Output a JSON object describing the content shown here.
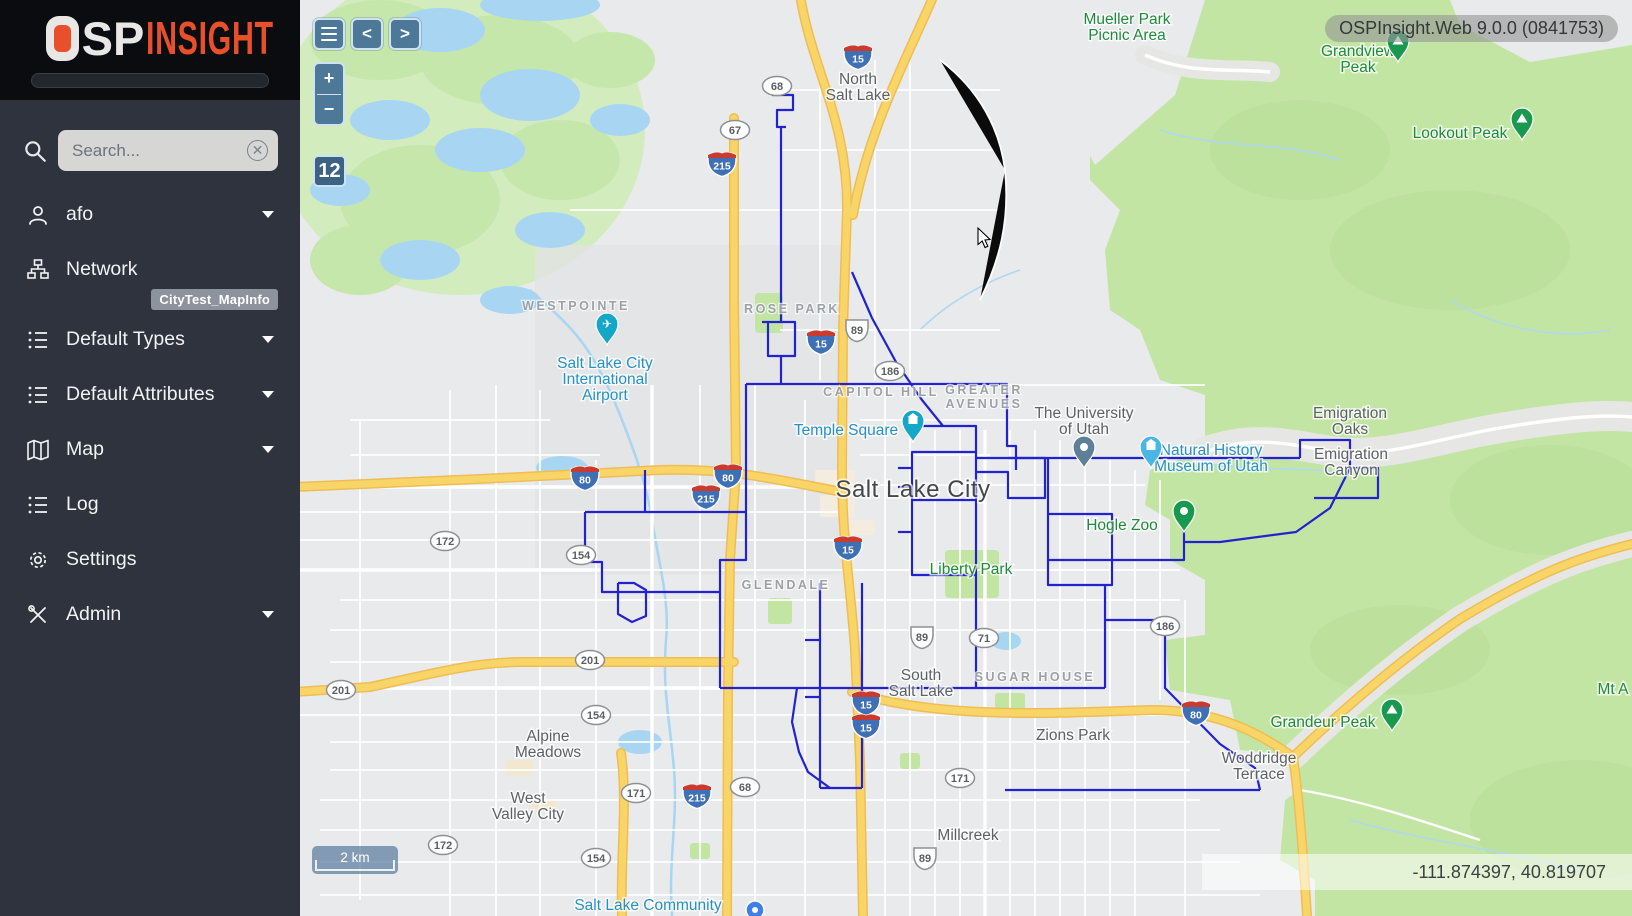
{
  "app": {
    "logo": {
      "o": "O",
      "sp": "SP",
      "insight": "INSIGHT"
    },
    "version_label": "OSPInsight.Web 9.0.0 (0841753)"
  },
  "sidebar": {
    "search": {
      "placeholder": "Search...",
      "clear_icon": "circled-x"
    },
    "items": [
      {
        "label": "afo",
        "icon": "user",
        "caret": true
      },
      {
        "label": "Network",
        "icon": "network",
        "caret": false,
        "badge": "CityTest_MapInfo"
      },
      {
        "label": "Default Types",
        "icon": "list",
        "caret": true
      },
      {
        "label": "Default Attributes",
        "icon": "list",
        "caret": true
      },
      {
        "label": "Map",
        "icon": "map",
        "caret": true
      },
      {
        "label": "Log",
        "icon": "list",
        "caret": false
      },
      {
        "label": "Settings",
        "icon": "gear",
        "caret": false
      },
      {
        "label": "Admin",
        "icon": "tools",
        "caret": true
      }
    ]
  },
  "map": {
    "controls": {
      "menu": "menu",
      "prev": "<",
      "next": ">",
      "zoom_in": "+",
      "zoom_out": "−",
      "zoom_level": "12"
    },
    "scale_label": "2 km",
    "coordinates": "-111.874397, 40.819707",
    "colors": {
      "network_line": "#2222cf",
      "control_blue": "#4e7898",
      "accent_orange": "#e84f2b",
      "park_green": "#c3e5a4",
      "water_blue": "#a8d6f2",
      "highway_yellow": "#f9d567"
    },
    "overlay": {
      "labels": [
        {
          "type": "city",
          "x": 558,
          "y": 84,
          "lines": [
            "North",
            "Salt Lake"
          ]
        },
        {
          "type": "park",
          "x": 827,
          "y": 24,
          "lines": [
            "Mueller Park",
            "Picnic Area"
          ]
        },
        {
          "type": "park",
          "x": 1058,
          "y": 56,
          "lines": [
            "Grandview",
            "Peak"
          ]
        },
        {
          "type": "park",
          "x": 1160,
          "y": 138,
          "lines": [
            "Lookout Peak"
          ]
        },
        {
          "type": "district",
          "x": 276,
          "y": 310,
          "lines": [
            "WESTPOINTE"
          ]
        },
        {
          "type": "poi",
          "x": 305,
          "y": 368,
          "lines": [
            "Salt Lake City",
            "International",
            "Airport"
          ]
        },
        {
          "type": "district",
          "x": 492,
          "y": 313,
          "lines": [
            "ROSE PARK"
          ]
        },
        {
          "type": "district",
          "x": 581,
          "y": 396,
          "lines": [
            "CAPITOL HILL"
          ]
        },
        {
          "type": "district",
          "x": 684,
          "y": 394,
          "lines": [
            "GREATER",
            "AVENUES"
          ]
        },
        {
          "type": "poi",
          "x": 546,
          "y": 435,
          "lines": [
            "Temple Square"
          ]
        },
        {
          "type": "city",
          "x": 784,
          "y": 418,
          "lines": [
            "The University",
            "of Utah"
          ]
        },
        {
          "type": "poi",
          "x": 911,
          "y": 455,
          "lines": [
            "Natural History",
            "Museum of Utah"
          ]
        },
        {
          "type": "city",
          "x": 1050,
          "y": 418,
          "lines": [
            "Emigration",
            "Oaks"
          ]
        },
        {
          "type": "city",
          "x": 1051,
          "y": 459,
          "lines": [
            "Emigration",
            "Canyon"
          ]
        },
        {
          "type": "city-lg",
          "x": 613,
          "y": 497,
          "lines": [
            "Salt Lake City"
          ]
        },
        {
          "type": "park",
          "x": 822,
          "y": 530,
          "lines": [
            "Hogle Zoo"
          ]
        },
        {
          "type": "park",
          "x": 671,
          "y": 574,
          "lines": [
            "Liberty Park"
          ]
        },
        {
          "type": "district",
          "x": 486,
          "y": 589,
          "lines": [
            "GLENDALE"
          ]
        },
        {
          "type": "city",
          "x": 621,
          "y": 680,
          "lines": [
            "South",
            "Salt Lake"
          ]
        },
        {
          "type": "district",
          "x": 735,
          "y": 681,
          "lines": [
            "SUGAR HOUSE"
          ]
        },
        {
          "type": "city",
          "x": 773,
          "y": 740,
          "lines": [
            "Zions Park"
          ]
        },
        {
          "type": "city",
          "x": 248,
          "y": 741,
          "lines": [
            "Alpine",
            "Meadows"
          ]
        },
        {
          "type": "city",
          "x": 228,
          "y": 803,
          "lines": [
            "West",
            "Valley City"
          ]
        },
        {
          "type": "park",
          "x": 1023,
          "y": 727,
          "lines": [
            "Grandeur Peak"
          ]
        },
        {
          "type": "city",
          "x": 959,
          "y": 763,
          "lines": [
            "Woddridge",
            "Terrace"
          ]
        },
        {
          "type": "city",
          "x": 668,
          "y": 840,
          "lines": [
            "Millcreek"
          ]
        },
        {
          "type": "park",
          "x": 1313,
          "y": 694,
          "lines": [
            "Mt A"
          ]
        },
        {
          "type": "poi",
          "x": 348,
          "y": 910,
          "lines": [
            "Salt Lake Community"
          ]
        }
      ],
      "markers": [
        {
          "kind": "peak",
          "x": 1098,
          "y": 62
        },
        {
          "kind": "peak",
          "x": 1222,
          "y": 140
        },
        {
          "kind": "airport",
          "x": 307,
          "y": 345
        },
        {
          "kind": "temple",
          "x": 613,
          "y": 442
        },
        {
          "kind": "university",
          "x": 784,
          "y": 468
        },
        {
          "kind": "museum",
          "x": 851,
          "y": 468
        },
        {
          "kind": "zoo",
          "x": 884,
          "y": 532
        },
        {
          "kind": "peak",
          "x": 1092,
          "y": 731
        },
        {
          "kind": "college",
          "x": 455,
          "y": 910
        }
      ],
      "marker_colors": {
        "peak": "#18994f",
        "airport": "#14a7c7",
        "temple": "#14a7c7",
        "university": "#5e7f99",
        "museum": "#49b6e6",
        "zoo": "#18994f",
        "college": "#3f7fe8"
      },
      "shields": [
        {
          "type": "state",
          "label": "68",
          "x": 477,
          "y": 86
        },
        {
          "type": "state",
          "label": "67",
          "x": 435,
          "y": 130
        },
        {
          "type": "interstate",
          "label": "215",
          "x": 422,
          "y": 164
        },
        {
          "type": "interstate",
          "label": "15",
          "x": 558,
          "y": 57
        },
        {
          "type": "us",
          "label": "89",
          "x": 557,
          "y": 330
        },
        {
          "type": "interstate",
          "label": "15",
          "x": 521,
          "y": 342
        },
        {
          "type": "state",
          "label": "186",
          "x": 590,
          "y": 371
        },
        {
          "type": "interstate",
          "label": "80",
          "x": 285,
          "y": 478
        },
        {
          "type": "interstate",
          "label": "80",
          "x": 428,
          "y": 476
        },
        {
          "type": "interstate",
          "label": "215",
          "x": 406,
          "y": 497
        },
        {
          "type": "state",
          "label": "172",
          "x": 145,
          "y": 541
        },
        {
          "type": "state",
          "label": "154",
          "x": 281,
          "y": 555
        },
        {
          "type": "interstate",
          "label": "15",
          "x": 548,
          "y": 548
        },
        {
          "type": "state",
          "label": "201",
          "x": 41,
          "y": 690
        },
        {
          "type": "state",
          "label": "201",
          "x": 290,
          "y": 660
        },
        {
          "type": "state",
          "label": "154",
          "x": 296,
          "y": 715
        },
        {
          "type": "us",
          "label": "89",
          "x": 622,
          "y": 637
        },
        {
          "type": "state",
          "label": "71",
          "x": 684,
          "y": 638
        },
        {
          "type": "state",
          "label": "186",
          "x": 865,
          "y": 626
        },
        {
          "type": "interstate",
          "label": "15",
          "x": 566,
          "y": 703
        },
        {
          "type": "interstate",
          "label": "15",
          "x": 566,
          "y": 726
        },
        {
          "type": "interstate",
          "label": "80",
          "x": 896,
          "y": 713
        },
        {
          "type": "state",
          "label": "171",
          "x": 336,
          "y": 793
        },
        {
          "type": "state",
          "label": "171",
          "x": 660,
          "y": 778
        },
        {
          "type": "interstate",
          "label": "215",
          "x": 397,
          "y": 796
        },
        {
          "type": "state",
          "label": "68",
          "x": 445,
          "y": 787
        },
        {
          "type": "state",
          "label": "172",
          "x": 143,
          "y": 845
        },
        {
          "type": "state",
          "label": "154",
          "x": 296,
          "y": 858
        },
        {
          "type": "us",
          "label": "89",
          "x": 625,
          "y": 858
        }
      ],
      "network": [
        [
          [
            472,
            95
          ],
          [
            493,
            95
          ],
          [
            493,
            110
          ],
          [
            477,
            110
          ],
          [
            477,
            127
          ],
          [
            486,
            127
          ]
        ],
        [
          [
            481,
            127
          ],
          [
            481,
            322
          ]
        ],
        [
          [
            462,
            322
          ],
          [
            495,
            322
          ],
          [
            495,
            356
          ],
          [
            468,
            356
          ],
          [
            468,
            322
          ]
        ],
        [
          [
            481,
            356
          ],
          [
            481,
            384
          ]
        ],
        [
          [
            446,
            384
          ],
          [
            707,
            384
          ],
          [
            707,
            446
          ],
          [
            716,
            446
          ],
          [
            716,
            470
          ]
        ],
        [
          [
            552,
            272
          ],
          [
            572,
            318
          ],
          [
            596,
            362
          ],
          [
            622,
            400
          ],
          [
            643,
            426
          ]
        ],
        [
          [
            604,
            426
          ],
          [
            676,
            426
          ],
          [
            676,
            452
          ],
          [
            612,
            452
          ],
          [
            612,
            575
          ],
          [
            676,
            575
          ],
          [
            676,
            452
          ]
        ],
        [
          [
            612,
            500
          ],
          [
            676,
            500
          ]
        ],
        [
          [
            676,
            472
          ],
          [
            708,
            472
          ],
          [
            708,
            498
          ],
          [
            745,
            498
          ],
          [
            745,
            458
          ],
          [
            708,
            458
          ]
        ],
        [
          [
            598,
            468
          ],
          [
            612,
            468
          ]
        ],
        [
          [
            598,
            487
          ],
          [
            612,
            487
          ]
        ],
        [
          [
            598,
            532
          ],
          [
            612,
            532
          ]
        ],
        [
          [
            446,
            384
          ],
          [
            446,
            512
          ]
        ],
        [
          [
            285,
            512
          ],
          [
            446,
            512
          ]
        ],
        [
          [
            285,
            512
          ],
          [
            285,
            562
          ],
          [
            302,
            562
          ],
          [
            302,
            592
          ],
          [
            420,
            592
          ],
          [
            420,
            560
          ],
          [
            446,
            560
          ],
          [
            446,
            512
          ]
        ],
        [
          [
            345,
            470
          ],
          [
            345,
            512
          ]
        ],
        [
          [
            420,
            592
          ],
          [
            420,
            688
          ]
        ],
        [
          [
            520,
            583
          ],
          [
            520,
            788
          ]
        ],
        [
          [
            562,
            583
          ],
          [
            562,
            788
          ]
        ],
        [
          [
            520,
            788
          ],
          [
            562,
            788
          ]
        ],
        [
          [
            505,
            640
          ],
          [
            520,
            640
          ]
        ],
        [
          [
            505,
            697
          ],
          [
            520,
            697
          ]
        ],
        [
          [
            420,
            688
          ],
          [
            805,
            688
          ]
        ],
        [
          [
            676,
            575
          ],
          [
            676,
            688
          ]
        ],
        [
          [
            748,
            458
          ],
          [
            748,
            514
          ]
        ],
        [
          [
            676,
            458
          ],
          [
            1000,
            458
          ]
        ],
        [
          [
            748,
            514
          ],
          [
            812,
            514
          ],
          [
            812,
            585
          ],
          [
            748,
            585
          ],
          [
            748,
            514
          ]
        ],
        [
          [
            805,
            585
          ],
          [
            805,
            688
          ]
        ],
        [
          [
            805,
            620
          ],
          [
            865,
            620
          ],
          [
            865,
            688
          ],
          [
            920,
            744
          ],
          [
            955,
            768
          ],
          [
            960,
            790
          ]
        ],
        [
          [
            705,
            790
          ],
          [
            960,
            790
          ]
        ],
        [
          [
            497,
            688
          ],
          [
            492,
            722
          ],
          [
            499,
            752
          ],
          [
            508,
            772
          ],
          [
            530,
            788
          ]
        ],
        [
          [
            318,
            583
          ],
          [
            318,
            614
          ],
          [
            332,
            622
          ],
          [
            346,
            616
          ],
          [
            346,
            590
          ],
          [
            334,
            583
          ],
          [
            318,
            583
          ]
        ],
        [
          [
            1000,
            458
          ],
          [
            1000,
            440
          ],
          [
            1050,
            440
          ],
          [
            1050,
            468
          ],
          [
            1078,
            468
          ],
          [
            1078,
            498
          ],
          [
            1014,
            498
          ]
        ],
        [
          [
            1050,
            468
          ],
          [
            1030,
            508
          ],
          [
            996,
            532
          ],
          [
            920,
            542
          ],
          [
            884,
            542
          ],
          [
            884,
            518
          ]
        ],
        [
          [
            884,
            542
          ],
          [
            884,
            560
          ],
          [
            748,
            560
          ]
        ]
      ],
      "cursor": {
        "x": 678,
        "y": 228
      }
    }
  }
}
